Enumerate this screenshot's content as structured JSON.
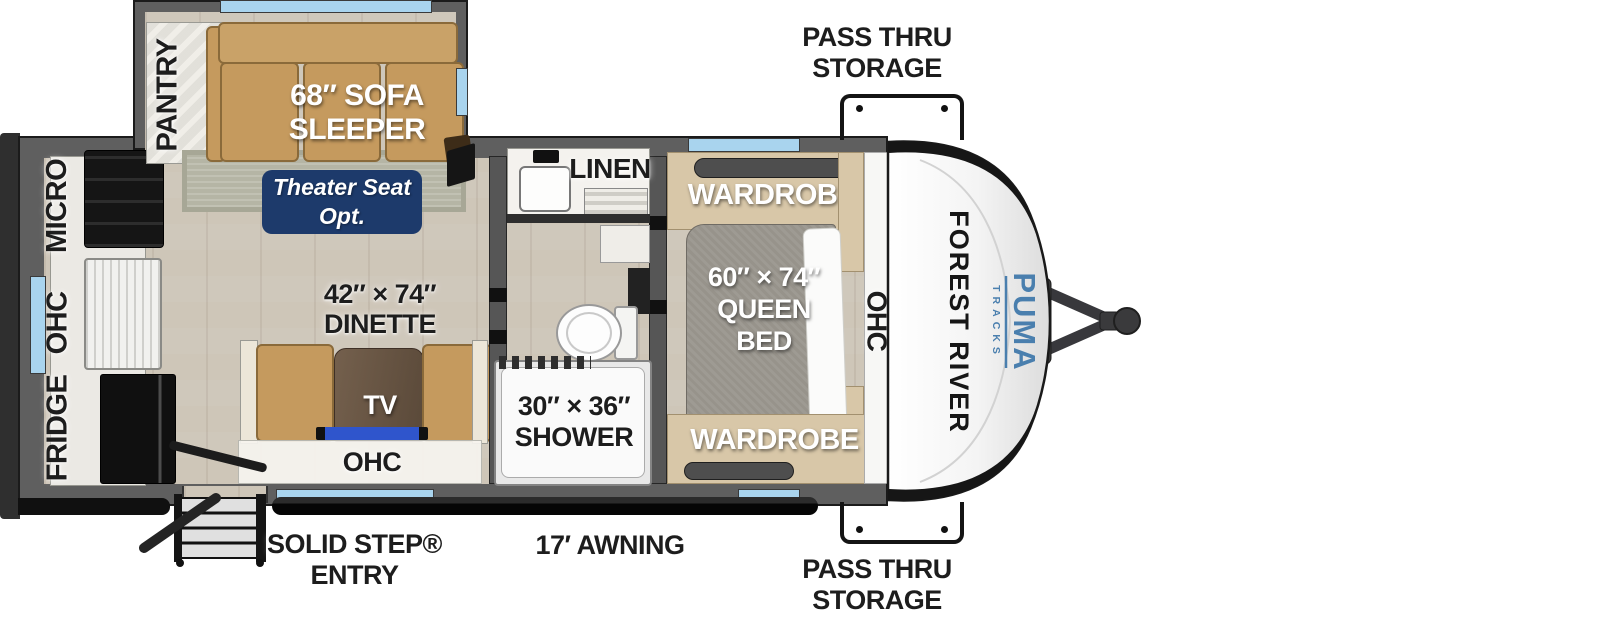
{
  "exterior": {
    "pass_thru_top": {
      "line1": "PASS THRU",
      "line2": "STORAGE"
    },
    "pass_thru_bottom": {
      "line1": "PASS THRU",
      "line2": "STORAGE"
    },
    "solid_step": {
      "line1": "SOLID STEP®",
      "line2": "ENTRY"
    },
    "awning_label": "17′ AWNING",
    "front_cap": {
      "brand": "FOREST RIVER",
      "model": "PUMA",
      "model_sub": "TRACKS"
    }
  },
  "kitchen": {
    "micro": "MICRO",
    "ohc": "OHC",
    "fridge": "FRIDGE",
    "pantry": "PANTRY"
  },
  "living": {
    "sofa_line1": "68″ SOFA",
    "sofa_line2": "SLEEPER",
    "theater_line1": "Theater Seat",
    "theater_line2": "Opt.",
    "dinette_line1": "42″ × 74″",
    "dinette_line2": "DINETTE",
    "tv": "TV",
    "ohc": "OHC"
  },
  "bath": {
    "linen": "LINEN",
    "shower_line1": "30″ × 36″",
    "shower_line2": "SHOWER"
  },
  "bedroom": {
    "wardrobe_top": "WARDROBE",
    "wardrobe_bottom": "WARDROBE",
    "bed_line1": "60″ × 74″",
    "bed_line2": "QUEEN BED",
    "ohc": "OHC"
  },
  "colors": {
    "window_blue": "#a9d4ee",
    "badge_navy": "#1d3a6b",
    "puma_blue": "#4a7fae",
    "sofa_tan": "#c59a5e",
    "wall_gray": "#5f5f5f"
  }
}
